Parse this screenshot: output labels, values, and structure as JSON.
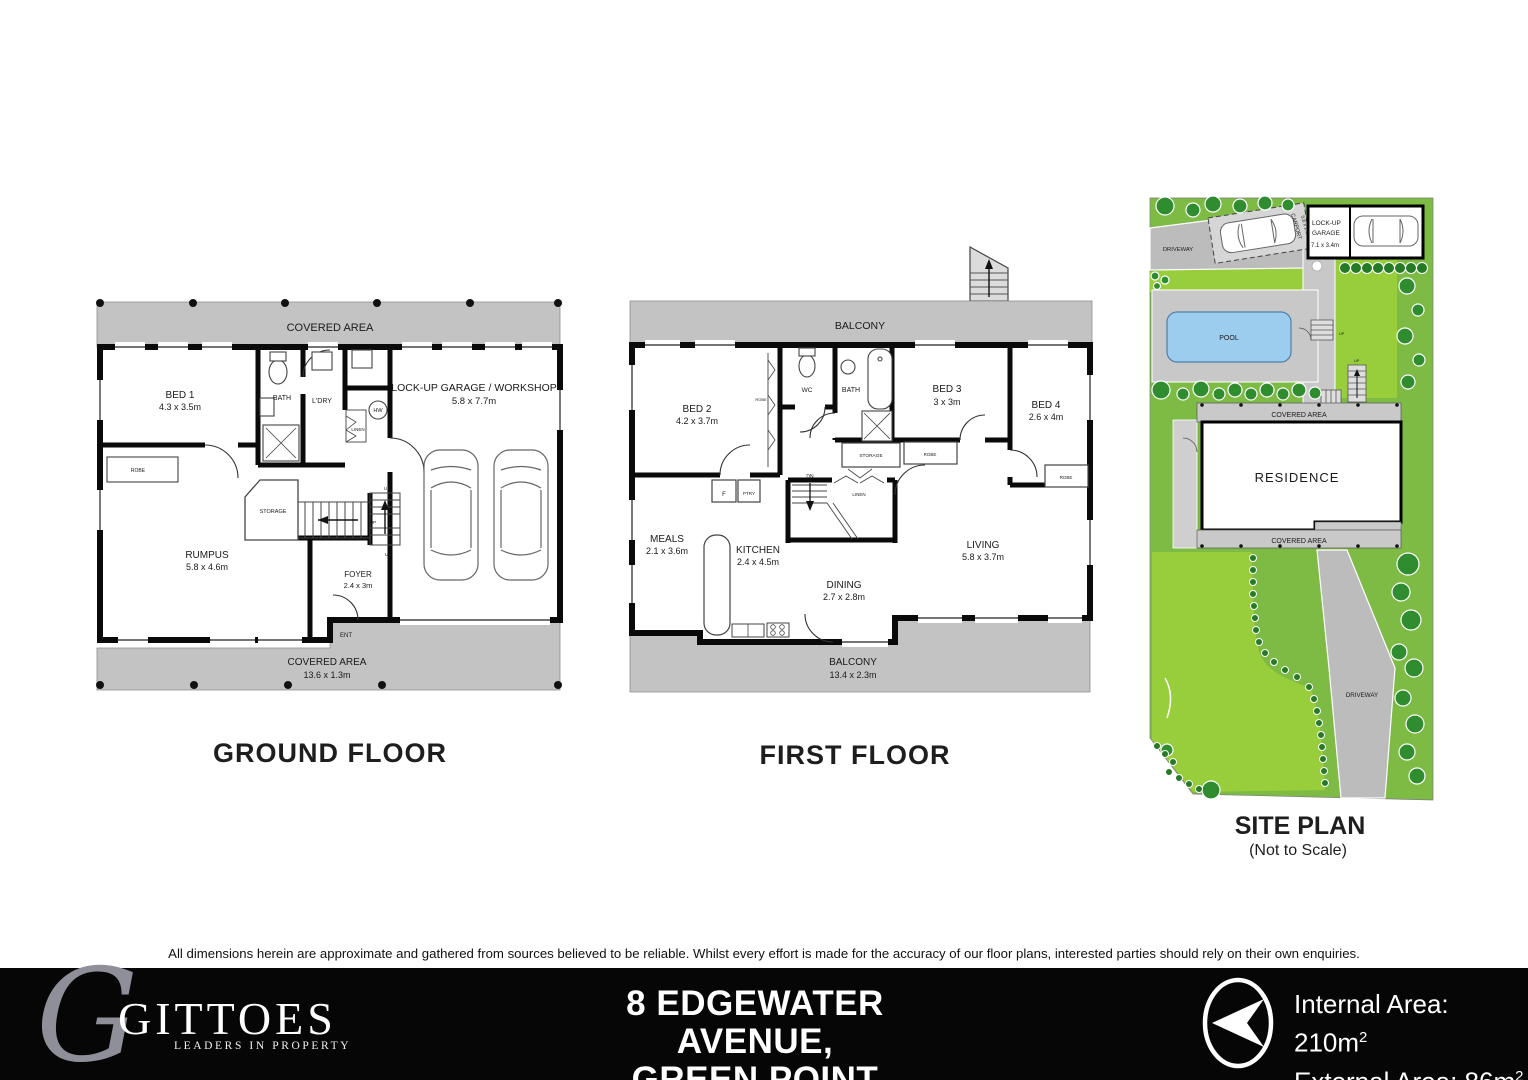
{
  "gf": {
    "title": "GROUND FLOOR",
    "covered_top": "COVERED AREA",
    "covered_bottom": "COVERED AREA",
    "covered_bottom_dims": "13.6 x 1.3m",
    "bed1": "BED 1",
    "bed1_dims": "4.3 x 3.5m",
    "bath": "BATH",
    "ldry": "L'DRY",
    "linen": "LINEN",
    "hw": "HW",
    "garage": "LOCK-UP GARAGE / WORKSHOP",
    "garage_dims": "5.8 x 7.7m",
    "robe": "ROBE",
    "storage": "STORAGE",
    "rumpus": "RUMPUS",
    "rumpus_dims": "5.8 x 4.6m",
    "foyer": "FOYER",
    "foyer_dims": "2.4 x 3m",
    "ent": "ENT",
    "up": "UP"
  },
  "ff": {
    "title": "FIRST FLOOR",
    "balcony_top": "BALCONY",
    "balcony_bottom": "BALCONY",
    "balcony_bottom_dims": "13.4 x 2.3m",
    "bed2": "BED 2",
    "bed2_dims": "4.2 x 3.7m",
    "bed3": "BED 3",
    "bed3_dims": "3 x 3m",
    "bed4": "BED 4",
    "bed4_dims": "2.6 x 4m",
    "wc": "WC",
    "bath": "BATH",
    "robe": "ROBE",
    "storage": "STORAGE",
    "linen": "LINEN",
    "f": "F",
    "ptry": "PTRY",
    "dn": "DN",
    "meals": "MEALS",
    "meals_dims": "2.1 x 3.6m",
    "kitchen": "KITCHEN",
    "kitchen_dims": "2.4 x 4.5m",
    "dining": "DINING",
    "dining_dims": "2.7 x 2.8m",
    "living": "LIVING",
    "living_dims": "5.8 x 3.7m"
  },
  "site": {
    "title": "SITE PLAN",
    "subtitle": "(Not to Scale)",
    "driveway_top": "DRIVEWAY",
    "driveway_bottom": "DRIVEWAY",
    "carport": "CARPORT",
    "carport_dims": "5.6 x 2.5m",
    "garage_line1": "LOCK-UP",
    "garage_line2": "GARAGE",
    "garage_dims": "7.1 x 3.4m",
    "pool": "POOL",
    "residence": "RESIDENCE",
    "covered": "COVERED AREA",
    "up": "UP"
  },
  "footer": {
    "disclaimer": "All dimensions herein are approximate and gathered from sources believed to be reliable. Whilst every effort is made for the accuracy of our floor plans, interested parties should rely on their own enquiries.",
    "brand_monogram": "G",
    "brand_name": "GITTOES",
    "brand_tagline": "LEADERS IN PROPERTY",
    "address_line1": "8 EDGEWATER AVENUE,",
    "address_line2": "GREEN POINT",
    "internal_area": "Internal Area: 210m",
    "internal_area_sup": "2",
    "external_area": "External Area: 86m",
    "external_area_sup": "2"
  },
  "colors": {
    "covered_gray": "#c3c3c3",
    "site_covered_gray": "#c9c9c9",
    "lawn_bright": "#98cd3c",
    "green_mid": "#7dbb45",
    "pool_blue": "#9dcdee",
    "driveway_gray": "#bcbcbc",
    "pad_gray": "#c8c8c8",
    "tree_green": "#2f8c2f",
    "shrub_green": "#267a26",
    "bar_black": "#060606",
    "wall_black": "#0a0a0a"
  }
}
